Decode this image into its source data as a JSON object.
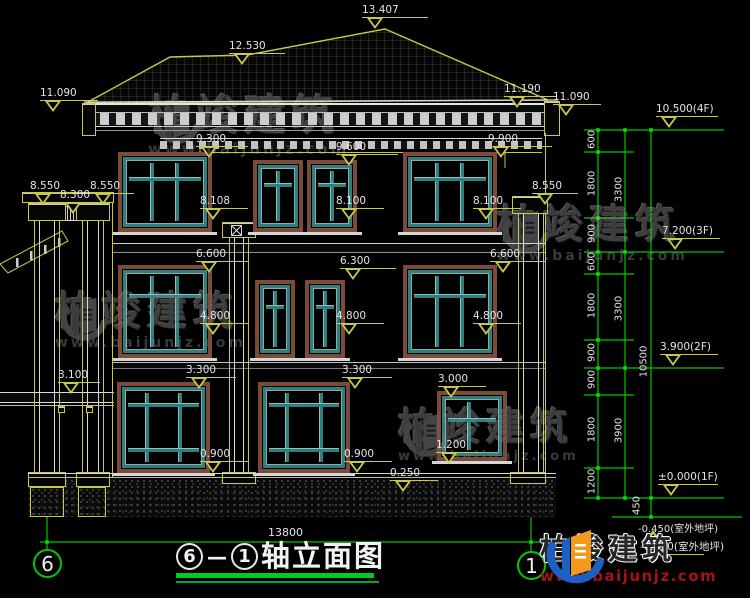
{
  "meta": {
    "colors": {
      "background": "#000000",
      "cad_yellow": "#c8c84e",
      "cad_green": "#00c800",
      "white": "#e4e4e4",
      "window_teal": "#2f807d",
      "window_brown": "#7b4a3b",
      "logo_blue": "#1d5fc2",
      "logo_orange": "#f29a1d",
      "logo_url_red": "#a51414",
      "watermark_gray": "#4d4d4d"
    }
  },
  "title_block": {
    "axis_left": "6",
    "dash": "—",
    "axis_right": "1",
    "title_text": "轴立面图",
    "bottom_dim": "13800",
    "axis_bubble_left": "6",
    "axis_bubble_right": "1"
  },
  "elevation_labels": [
    {
      "text": "13.407",
      "x": 362,
      "y": 5,
      "u": 66,
      "d": "dn"
    },
    {
      "text": "12.530",
      "x": 229,
      "y": 41,
      "u": 56,
      "d": "dn"
    },
    {
      "text": "11.090",
      "x": 40,
      "y": 88,
      "u": 58,
      "d": "dn"
    },
    {
      "text": "11.190",
      "x": 504,
      "y": 84,
      "u": 52,
      "d": "dn"
    },
    {
      "text": "11.090",
      "x": 553,
      "y": 92,
      "u": 48,
      "d": "dn"
    },
    {
      "text": "9.300",
      "x": 196,
      "y": 134,
      "u": 52,
      "d": "dn"
    },
    {
      "text": "9.600",
      "x": 336,
      "y": 142,
      "u": 62,
      "d": "dn"
    },
    {
      "text": "9.900",
      "x": 488,
      "y": 134,
      "u": 64,
      "d": "dn"
    },
    {
      "text": "8.550",
      "x": 30,
      "y": 181,
      "u": 44,
      "d": "dn"
    },
    {
      "text": "8.300",
      "x": 60,
      "y": 190,
      "u": 40,
      "d": "dn"
    },
    {
      "text": "8.550",
      "x": 90,
      "y": 181,
      "u": 44,
      "d": "dn"
    },
    {
      "text": "8.550",
      "x": 532,
      "y": 181,
      "u": 46,
      "d": "dn"
    },
    {
      "text": "8.108",
      "x": 200,
      "y": 196,
      "u": 48,
      "d": "dn"
    },
    {
      "text": "8.100",
      "x": 336,
      "y": 196,
      "u": 48,
      "d": "dn"
    },
    {
      "text": "8.100",
      "x": 473,
      "y": 196,
      "u": 48,
      "d": "dn"
    },
    {
      "text": "6.600",
      "x": 196,
      "y": 249,
      "u": 52,
      "d": "dn"
    },
    {
      "text": "6.300",
      "x": 340,
      "y": 256,
      "u": 56,
      "d": "dn"
    },
    {
      "text": "6.600",
      "x": 490,
      "y": 249,
      "u": 56,
      "d": "dn"
    },
    {
      "text": "4.800",
      "x": 200,
      "y": 311,
      "u": 48,
      "d": "dn"
    },
    {
      "text": "4.800",
      "x": 336,
      "y": 311,
      "u": 48,
      "d": "dn"
    },
    {
      "text": "4.800",
      "x": 473,
      "y": 311,
      "u": 48,
      "d": "dn"
    },
    {
      "text": "3.100",
      "x": 58,
      "y": 370,
      "u": 42,
      "d": "dn"
    },
    {
      "text": "3.300",
      "x": 186,
      "y": 365,
      "u": 50,
      "d": "dn"
    },
    {
      "text": "3.300",
      "x": 342,
      "y": 365,
      "u": 50,
      "d": "dn"
    },
    {
      "text": "3.000",
      "x": 438,
      "y": 374,
      "u": 48,
      "d": "dn"
    },
    {
      "text": "0.900",
      "x": 200,
      "y": 449,
      "u": 48,
      "d": "dn"
    },
    {
      "text": "0.900",
      "x": 344,
      "y": 449,
      "u": 48,
      "d": "dn"
    },
    {
      "text": "1.200",
      "x": 436,
      "y": 440,
      "u": 46,
      "d": "dn"
    },
    {
      "text": "0.250",
      "x": 390,
      "y": 468,
      "u": 48,
      "d": "dn"
    }
  ],
  "floor_markers": [
    {
      "text": "10.500(4F)",
      "x": 656,
      "y": 104,
      "u": 62,
      "d": "dn"
    },
    {
      "text": "7.200(3F)",
      "x": 662,
      "y": 226,
      "u": 58,
      "d": "dn"
    },
    {
      "text": "3.900(2F)",
      "x": 660,
      "y": 342,
      "u": 58,
      "d": "dn"
    },
    {
      "text": "±0.000(1F)",
      "x": 658,
      "y": 472,
      "u": 60,
      "d": "dn"
    },
    {
      "text": "-0.450(室外地坪)",
      "x": 640,
      "y": 530,
      "u": 64,
      "d": "up"
    }
  ],
  "dim_chain_labels": [
    {
      "text": "600",
      "x": 592,
      "y": 141
    },
    {
      "text": "1800",
      "x": 592,
      "y": 185
    },
    {
      "text": "900",
      "x": 592,
      "y": 235
    },
    {
      "text": "600",
      "x": 592,
      "y": 263
    },
    {
      "text": "1800",
      "x": 592,
      "y": 307
    },
    {
      "text": "900",
      "x": 592,
      "y": 354
    },
    {
      "text": "900",
      "x": 592,
      "y": 381
    },
    {
      "text": "1800",
      "x": 592,
      "y": 431
    },
    {
      "text": "1200",
      "x": 592,
      "y": 483
    },
    {
      "text": "3300",
      "x": 619,
      "y": 191
    },
    {
      "text": "3300",
      "x": 619,
      "y": 310
    },
    {
      "text": "3900",
      "x": 619,
      "y": 432
    },
    {
      "text": "10500",
      "x": 644,
      "y": 363
    },
    {
      "text": "450",
      "x": 637,
      "y": 507
    }
  ],
  "windows": [
    {
      "x": 118,
      "y": 152,
      "w": 94,
      "h": 80,
      "type": "big3"
    },
    {
      "x": 253,
      "y": 160,
      "w": 50,
      "h": 72,
      "type": "narrow"
    },
    {
      "x": 307,
      "y": 160,
      "w": 50,
      "h": 72,
      "type": "narrow"
    },
    {
      "x": 403,
      "y": 152,
      "w": 94,
      "h": 80,
      "type": "big3"
    },
    {
      "x": 118,
      "y": 265,
      "w": 94,
      "h": 93,
      "type": "big3"
    },
    {
      "x": 255,
      "y": 280,
      "w": 40,
      "h": 78,
      "type": "narrow"
    },
    {
      "x": 305,
      "y": 280,
      "w": 40,
      "h": 78,
      "type": "narrow"
    },
    {
      "x": 403,
      "y": 265,
      "w": 94,
      "h": 93,
      "type": "big3"
    },
    {
      "x": 117,
      "y": 382,
      "w": 93,
      "h": 91,
      "type": "big1F"
    },
    {
      "x": 258,
      "y": 382,
      "w": 92,
      "h": 91,
      "type": "big1F"
    },
    {
      "x": 437,
      "y": 391,
      "w": 70,
      "h": 70,
      "type": "small"
    }
  ],
  "watermark": {
    "text": "柏竣建筑",
    "url": "www.baijunjz.com",
    "instances": [
      {
        "x": 148,
        "y": 95,
        "fs": 42,
        "ufs": 15
      },
      {
        "x": 497,
        "y": 205,
        "fs": 40,
        "ufs": 14
      },
      {
        "x": 55,
        "y": 292,
        "fs": 40,
        "ufs": 14
      },
      {
        "x": 398,
        "y": 408,
        "fs": 38,
        "ufs": 13
      }
    ]
  },
  "logo": {
    "text": "柏竣建筑",
    "url": "www.baijunjz.com"
  },
  "ground_label": "-0.450(室外地坪)"
}
